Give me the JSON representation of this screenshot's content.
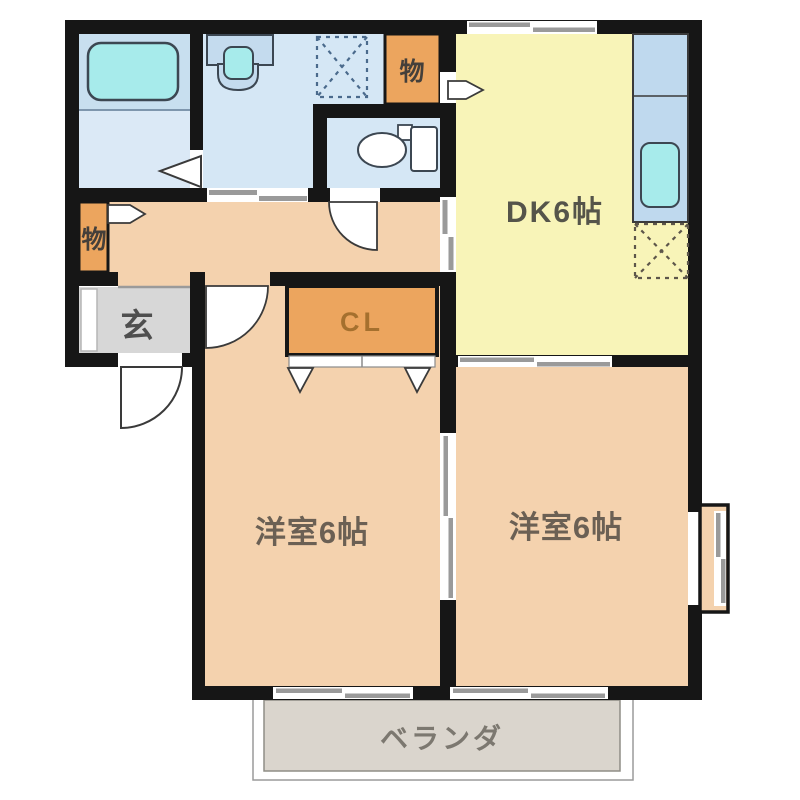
{
  "floorplan": {
    "type": "japanese-apartment-madori",
    "rooms": {
      "dk": {
        "label": "DK6帖"
      },
      "bedroom_left": {
        "label": "洋室6帖"
      },
      "bedroom_right": {
        "label": "洋室6帖"
      },
      "closet": {
        "label": "CL"
      },
      "entrance": {
        "label": "玄"
      },
      "storage_left": {
        "label": "物"
      },
      "storage_top": {
        "label": "物"
      },
      "veranda": {
        "label": "ベランダ"
      }
    },
    "colors": {
      "wall": "#161616",
      "room_pink": "#f4d2ae",
      "dk_yellow": "#f8f4b8",
      "water_blue": "#d5e7f5",
      "bath_blue": "#c8dfef",
      "fixture_cyan": "#a7ebeb",
      "closet_orange": "#eca55e",
      "genkan_gray": "#d7d7d7",
      "veranda_gray": "#dad5cd",
      "counter_blue": "#bfd9ee"
    },
    "text_colors": {
      "dk": "#55544a",
      "bedroom": "#6b6054",
      "cl": "#a5702e",
      "genkan": "#4f4f4f",
      "storage": "#443f3a",
      "veranda": "#7c7870"
    }
  }
}
